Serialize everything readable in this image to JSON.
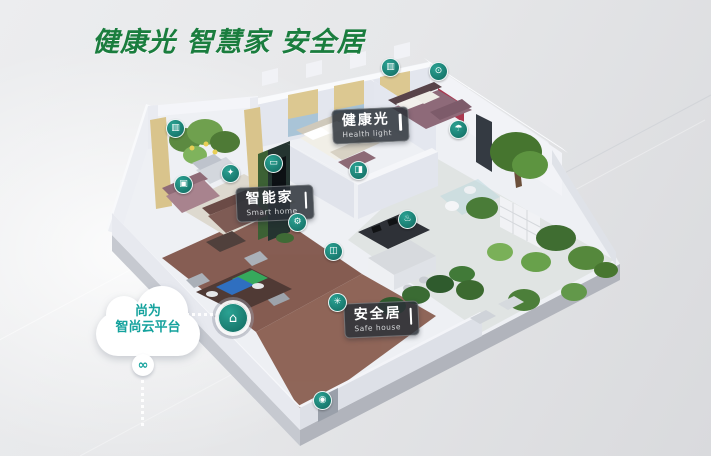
{
  "title": {
    "text": "健康光 智慧家 安全居",
    "color": "#1a7d3e"
  },
  "cloud_platform": {
    "line1": "尚为",
    "line2": "智尚云平台",
    "text_color": "#14a29d",
    "link_glyph": "∞"
  },
  "callouts": [
    {
      "id": "health-light",
      "zh": "健康光",
      "en": "Health light"
    },
    {
      "id": "smart-home",
      "zh": "智能家",
      "en": "Smart home"
    },
    {
      "id": "safe-house",
      "zh": "安全居",
      "en": "Safe house"
    }
  ],
  "device_icons": [
    {
      "name": "curtain-balcony",
      "glyph": "▥"
    },
    {
      "name": "curtain-bedroom",
      "glyph": "▥"
    },
    {
      "name": "ceiling-light",
      "glyph": "⊙"
    },
    {
      "name": "floor-lamp",
      "glyph": "✦"
    },
    {
      "name": "control-panel",
      "glyph": "▣"
    },
    {
      "name": "tv",
      "glyph": "▭"
    },
    {
      "name": "door-sensor",
      "glyph": "◨"
    },
    {
      "name": "air-quality-sensor",
      "glyph": "⚙"
    },
    {
      "name": "air-purifier",
      "glyph": "◫"
    },
    {
      "name": "stove-sensor",
      "glyph": "♨"
    },
    {
      "name": "humidity-sensor",
      "glyph": "☂"
    },
    {
      "name": "garden-irrigation",
      "glyph": "✳"
    },
    {
      "name": "doorbell-camera",
      "glyph": "◉"
    },
    {
      "name": "gateway-hub",
      "glyph": "⌂"
    }
  ],
  "colors": {
    "accent_green": "#1a7d3e",
    "device_teal": "#18847a",
    "cloud_text_teal": "#14a29d",
    "callout_bg": "#2c3138"
  }
}
